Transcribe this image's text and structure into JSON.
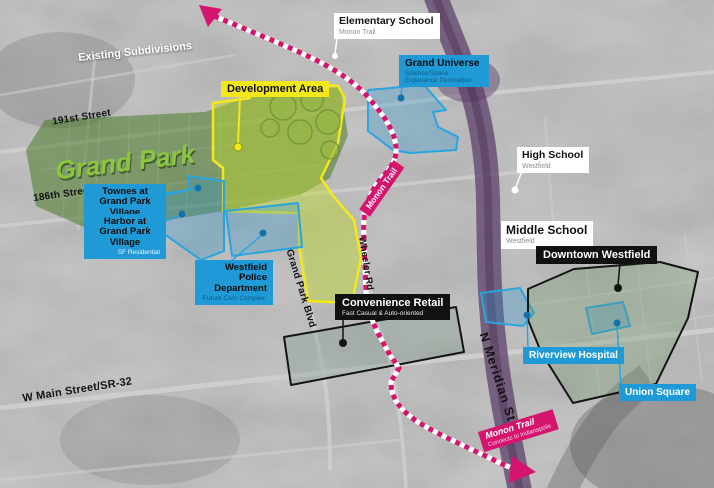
{
  "map_title": "Grand Park development area map",
  "area_labels": {
    "grand_park": "Grand Park",
    "existing_subdivisions": "Existing Subdivisions"
  },
  "streets": {
    "street_191": "191st Street",
    "street_186": "186th Street",
    "main_street": "W Main Street/SR-32",
    "grand_park_blvd": "Grand Park Blvd",
    "wheeler_rd": "Wheeler Rd",
    "meridian_st": "N Meridian St"
  },
  "trail": {
    "mid_label": "Monon Trail",
    "bottom_title": "Monon Trail",
    "bottom_sub": "Connects to Indianapolis"
  },
  "callouts": {
    "development_area": {
      "label": "Development Area"
    },
    "elementary_school": {
      "title": "Elementary School",
      "sub": "Monon Trail"
    },
    "high_school": {
      "title": "High School",
      "sub": "Westfield"
    },
    "middle_school": {
      "title": "Middle School",
      "sub": "Westfield"
    },
    "grand_universe": {
      "title": "Grand Universe",
      "sub": "Science/Space Experience Destination"
    },
    "townes": {
      "title": "Townes at Grand Park Village",
      "sub": "SF Residential"
    },
    "harbor": {
      "title": "Harbor at Grand Park Village",
      "sub": "SF Residential"
    },
    "police": {
      "title": "Westfield Police Department",
      "sub": "Future Civic Complex"
    },
    "convenience_retail": {
      "title": "Convenience Retail",
      "sub": "Fast Casual & Auto-oriented"
    },
    "downtown": {
      "title": "Downtown Westfield"
    },
    "riverview": {
      "title": "Riverview Hospital"
    },
    "union_square": {
      "title": "Union Square"
    }
  },
  "colors": {
    "callout_blue": "#1F9AD6",
    "trail_pink": "#D5146D",
    "development_yellow": "#F5E81A",
    "grand_park_green": "#8CC63F",
    "highway_purple": "#5A3C66",
    "outline_black": "#111111"
  }
}
